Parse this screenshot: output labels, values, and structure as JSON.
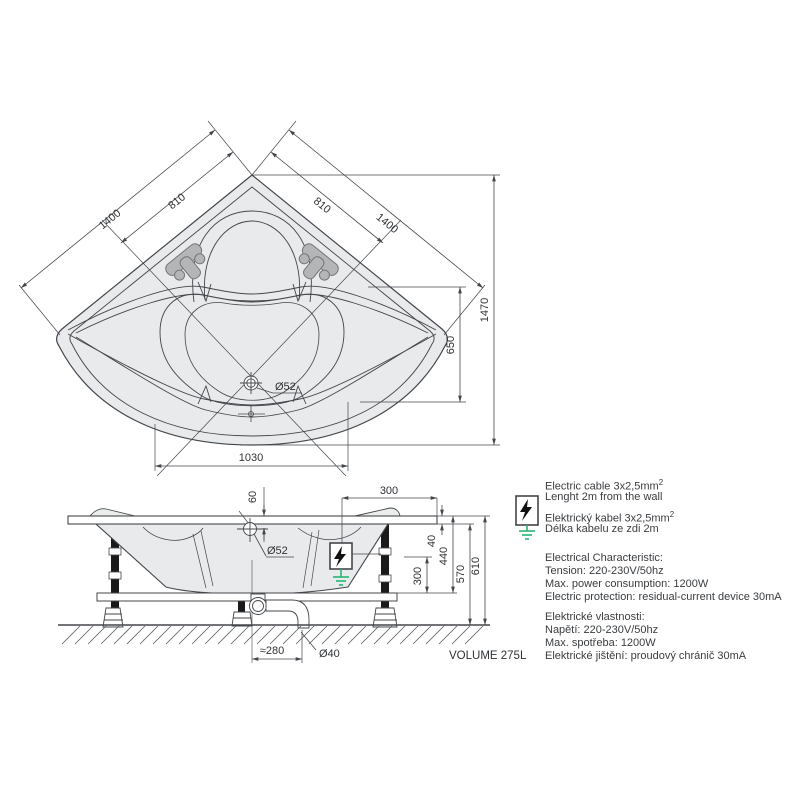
{
  "plan_view": {
    "dim_left_outer": "1400",
    "dim_left_inner": "810",
    "dim_right_inner": "810",
    "dim_right_outer": "1400",
    "dim_height_total": "1470",
    "dim_height_inner": "650",
    "dim_width_bottom": "1030",
    "drain_label": "Ø52"
  },
  "side_view": {
    "dim_drain_offset": "60",
    "dim_cable_position": "300",
    "drain_label": "Ø52",
    "dim_rim_thickness": "40",
    "dim_rim_to_frame": "440",
    "dim_under_rim": "570",
    "dim_total_height": "610",
    "dim_box_to_frame": "300",
    "dim_trap_offset": "≈280",
    "pipe_label": "Ø40",
    "volume_label": "VOLUME 275L"
  },
  "notes": {
    "sup2": "2",
    "cable_en_1": "Electric cable 3x2,5mm",
    "cable_en_2": "Lenght 2m from the wall",
    "cable_cz_1": "Elektrický kabel 3x2,5mm",
    "cable_cz_2": "Délka kabelu ze zdi 2m",
    "elec_en_title": "Electrical Characteristic:",
    "elec_en_1": "Tension: 220-230V/50hz",
    "elec_en_2": "Max. power consumption: 1200W",
    "elec_en_3": "Electric protection: residual-current device 30mA",
    "elec_cz_title": "Elektrické vlastnosti:",
    "elec_cz_1": "Napětí: 220-230V/50hz",
    "elec_cz_2": "Max. spotřeba: 1200W",
    "elec_cz_3": "Elektrické jištění: proudový chránič 30mA"
  },
  "colors": {
    "line": "#43474b",
    "tub_fill": "#e9eaec",
    "grip_fill": "#b3b5b7",
    "ground_green": "#27b574",
    "leg_black": "#1a1a1a"
  }
}
